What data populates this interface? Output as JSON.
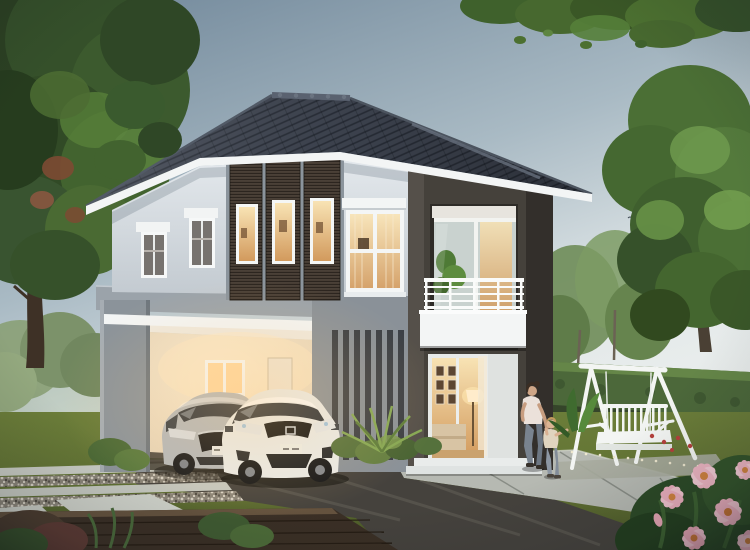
{
  "meta": {
    "type": "architectural-exterior-rendering",
    "subject": "modern two-storey detached house at dusk with lit windows",
    "visible_text": "none"
  },
  "palette": {
    "sky_top": "#6e8598",
    "sky_horizon": "#edf0ee",
    "roof": "#3e4450",
    "roof_ridge": "#5a6270",
    "fascia": "#f3f5f5",
    "wall": "#e3e8ec",
    "wall_shade": "#c3cad1",
    "slab": "#9ba3aa",
    "column": "#8b939a",
    "tower_frame": "#45413b",
    "slat_panel": "#4a4037",
    "louver_fin": "#3b3f45",
    "window_glow": "#f2cf96",
    "carport_wall": "#efe2cc",
    "lawn": "#6b7d39",
    "hedge": "#4c683a",
    "tree_dark": "#2c4123",
    "tree_mid": "#44662f",
    "tree_light": "#6f9a4d",
    "road": "#45423d",
    "walkway": "#b6b9b2",
    "paver": "#cbcec6",
    "deck": "#3a2f25",
    "swing": "#f3f5f3",
    "car_silver": "#b4b8bb",
    "car_white": "#e9ebe9",
    "flower_pink": "#eeb0bf",
    "flower_red": "#b5403c",
    "flower_orange": "#c07a35"
  },
  "inventory": {
    "house": {
      "storeys": 2,
      "balconies": 1,
      "carport_bays": 2,
      "slat_window_panels": 3,
      "vertical_fins": 7,
      "upper_side_windows": 2,
      "four_pane_window": 1,
      "glass_doors": 2
    },
    "vehicles": [
      {
        "kind": "hatchback",
        "color_name": "silver"
      },
      {
        "kind": "hatchback",
        "color_name": "white"
      }
    ],
    "people": [
      {
        "kind": "adult-woman"
      },
      {
        "kind": "child"
      }
    ],
    "garden": {
      "swing_bench": 1,
      "large_trees": 2,
      "hedges": true,
      "pink_flower_bush": true,
      "bird_flock": true
    }
  }
}
